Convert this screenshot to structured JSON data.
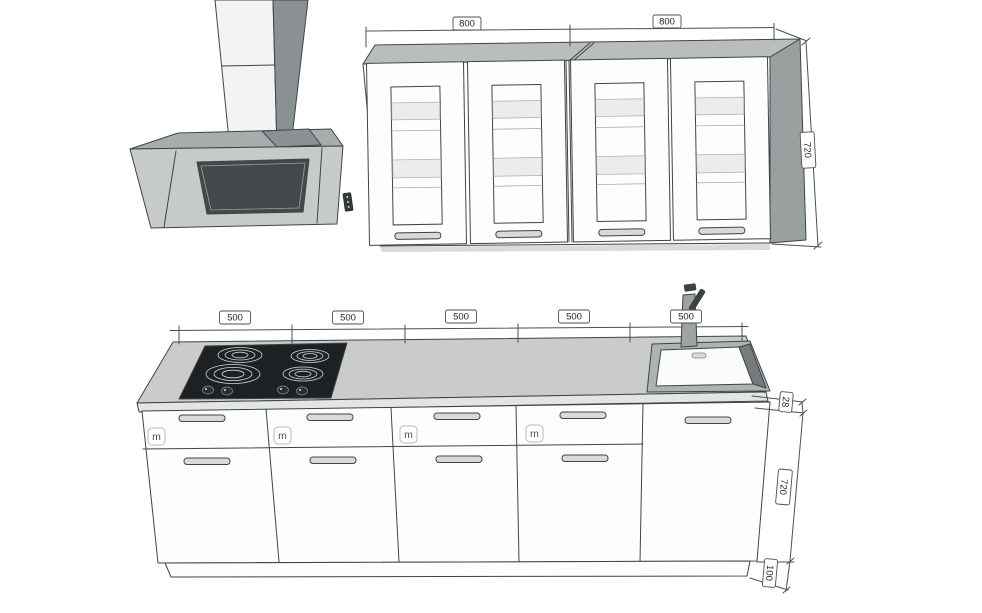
{
  "dims": {
    "wall_widths": [
      "800",
      "800"
    ],
    "wall_height": "720",
    "base_widths": [
      "500",
      "500",
      "500",
      "500",
      "500"
    ],
    "worktop_thickness": "28",
    "base_height": "720",
    "plinth_height": "100"
  },
  "badges": [
    "m",
    "m",
    "m",
    "m"
  ],
  "colors": {
    "background": "#ffffff",
    "line": "#3f4447",
    "top_face": "#b9bdbc",
    "side_face": "#9aa09f",
    "worktop": "#c9cccb",
    "worktop_edge": "#e3e5e4",
    "hood_body": "#c6cac9",
    "hood_canopy": "#a7adad",
    "chimney_front": "#f2f4f3",
    "chimney_side": "#8b9092",
    "screen": "#43484b",
    "cooktop": "#1d2123",
    "sink_rim": "#aeb3b2",
    "sink_basin": "#fafbfb",
    "sink_shadow": "#767b7d",
    "shadow_strip": "#d9dbdb"
  }
}
